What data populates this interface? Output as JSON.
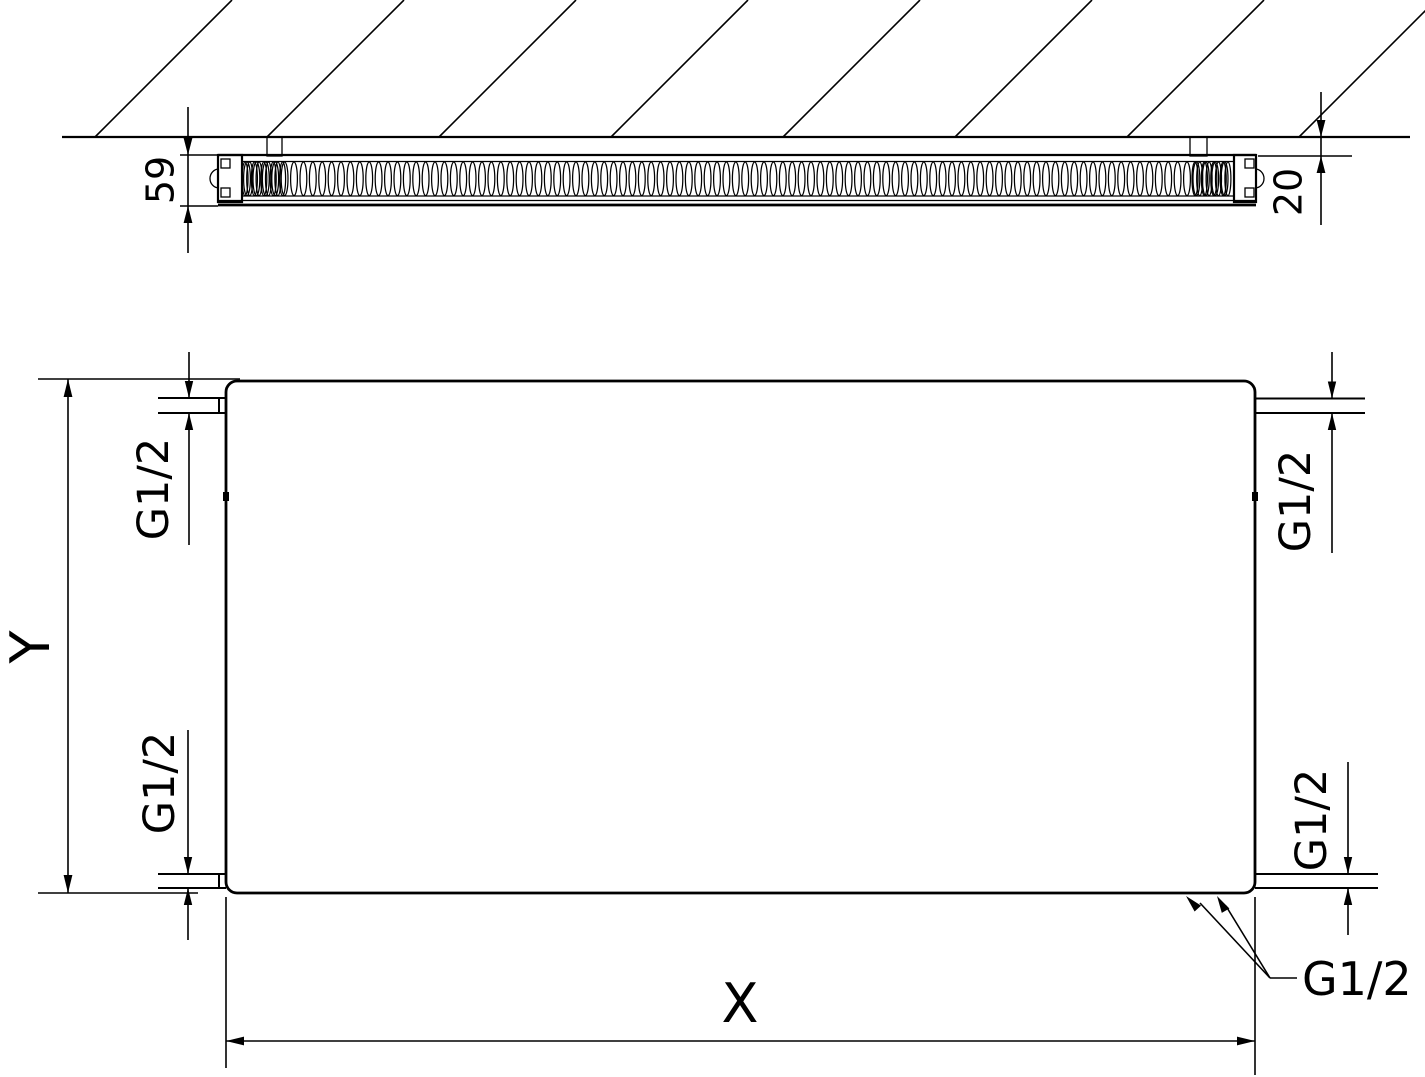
{
  "drawing": {
    "top_view": {
      "depth_dimension": "59",
      "wall_clearance_dimension": "20"
    },
    "front_view": {
      "height_dimension": "Y",
      "width_dimension": "X",
      "connection_top_left": "G1/2",
      "connection_top_right": "G1/2",
      "connection_bottom_left": "G1/2",
      "connection_bottom_right": "G1/2",
      "connection_bottom_callout": "G1/2"
    },
    "colors": {
      "ink": "#000000",
      "paper": "#ffffff"
    }
  }
}
